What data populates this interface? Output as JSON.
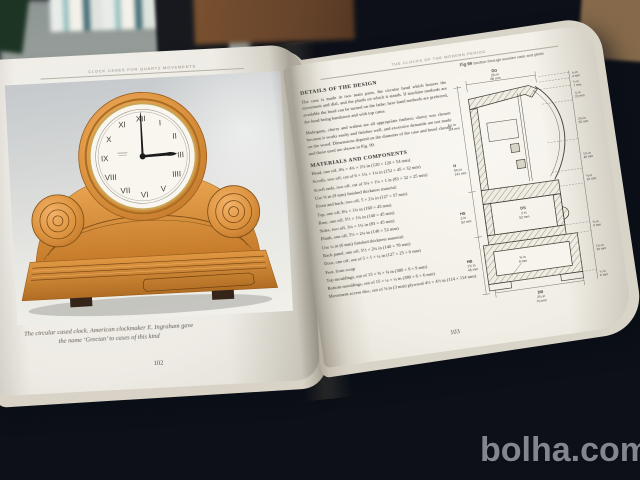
{
  "watermark": "bolha.com",
  "colors": {
    "cloth_blue": "#3c5176",
    "wood_orange": "#d98f3f",
    "paper": "#f4f1ea",
    "watermark_gray": "#8f9097"
  },
  "book": {
    "left_page": {
      "header": "CLOCK CASES FOR QUARTZ MOVEMENTS",
      "caption": "The circular cased clock. American clockmaker E. Ingraham gave the name ‘Grecian’ to cases of this kind",
      "page_number": "102",
      "clock": {
        "time": "3:00",
        "numerals": [
          "XII",
          "I",
          "II",
          "III",
          "IIII",
          "V",
          "VI",
          "VII",
          "VIII",
          "IX",
          "X",
          "XI"
        ]
      }
    },
    "right_page": {
      "header": "THE CLOCKS OF THE MODERN PERIOD",
      "page_number": "103",
      "design_heading": "DETAILS OF THE DESIGN",
      "design_paragraphs": [
        "The case is made in two main parts, the circular head which houses the movement and dial, and the plinth on which it stands. If machine methods are available the head can be turned on the lathe; here hand methods are preferred, the head being bandsawn and with top cams.",
        "Mahogany, cherry and walnut are all appropriate timbers; cherry was chosen because it works easily and finishes well, and excessive demands are not made on the wood. Dimensions depend on the diameter of the case and bezel chosen, and those used are shown in Fig. 99."
      ],
      "materials_heading": "MATERIALS AND COMPONENTS",
      "materials_lines": [
        "Head, one off, 4¾ × 4¾ × 2⅛ in (120 × 120 × 54 mm)",
        "Scrolls, two off, cut of 6 × 1¾ × 1¼ in (152 × 45 × 32 mm)",
        "Scroll ends, two off, cut of 3¼ × 1¼ × 1 in (83 × 32 × 25 mm)",
        "Use ⅜ in (9 mm) finished thickness material:",
        "Front and back, two off, 5 × 2¼ in (127 × 57 mm)",
        "Top, one off, 6¼ × 1¾ in (160 × 45 mm)",
        "Base, one off, 5½ × 1¾ in (140 × 45 mm)",
        "Sides, two off, 3¼ × 1¾ in (83 × 45 mm)",
        "Plinth, one off, 5½ × 2¼ in (140 × 52 mm)",
        "Use ¼ in (6 mm) finished thickness material:",
        "Back panel, one off, 5½ × 2¾ in (140 × 70 mm)",
        "Door, one off, out of 5 × 1 × ¼ in (127 × 25 × 6 mm)",
        "Feet, from scrap",
        "Top mouldings, out of 15 × ⅜ × ⅜ in (380 × 9 × 9 mm)",
        "Bottom mouldings, out of 15 × ¼ × ¼ in (380 × 6 × 6 mm)",
        "Movement access disc, out of ⅛ in (3 mm) plywood 4½ × 4½ in (114 × 114 mm)"
      ],
      "figure": {
        "caption_fig": "Fig 99",
        "caption_text": "Section through wooden case and plinth",
        "dim_top": {
          "code": "DG",
          "in": "2⅝ in",
          "mm": "66 mm"
        },
        "dims_left": [
          {
            "code": "",
            "in": "4½ in",
            "mm": "114 mm"
          },
          {
            "code": "H",
            "in": "5⅝ in",
            "mm": "141 mm"
          },
          {
            "code": "HS",
            "in": "2 in",
            "mm": "52 mm"
          },
          {
            "code": "HB",
            "in": "1¾ in",
            "mm": "45 mm"
          }
        ],
        "dim_center": {
          "code": "DS",
          "in": "2 in",
          "mm": "52 mm"
        },
        "dim_inner": {
          "in": "⅜ in",
          "mm": "9 mm"
        },
        "dim_bottom": {
          "code": "DB",
          "in": "2¾ in",
          "mm": "70 mm"
        },
        "dims_right": [
          {
            "in": "⅛ in",
            "mm": "4 mm"
          },
          {
            "in": "¼ in",
            "mm": "7 mm"
          },
          {
            "in": "⅞ in",
            "mm": "22 mm"
          },
          {
            "in": "2⅛ in",
            "mm": "55 mm"
          },
          {
            "in": "1⅝ in",
            "mm": "40 mm"
          },
          {
            "in": "⅜ in",
            "mm": "10 mm"
          },
          {
            "in": "⅜ in",
            "mm": "9 mm"
          },
          {
            "in": "1⅛ in",
            "mm": "30 mm"
          },
          {
            "in": "¼ in",
            "mm": "6 mm"
          }
        ]
      }
    }
  }
}
